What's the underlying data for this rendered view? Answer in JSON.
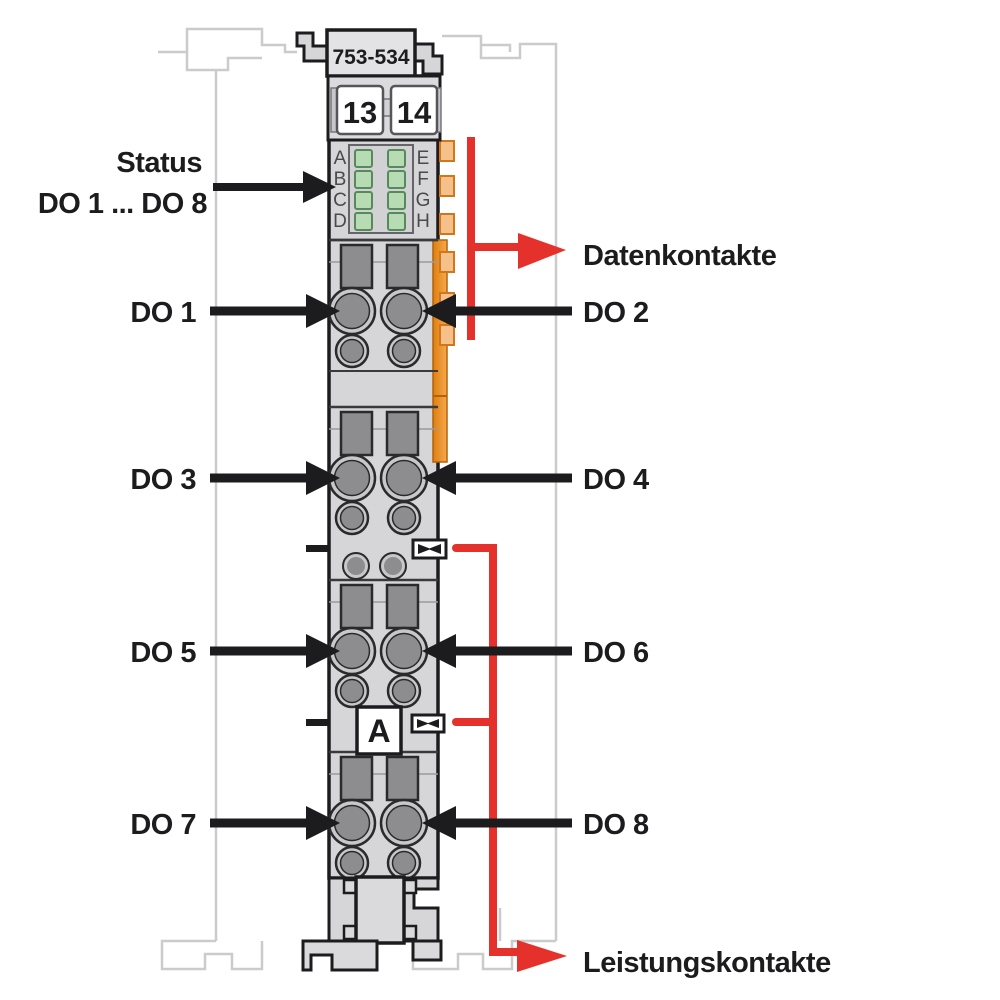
{
  "module": {
    "part_number": "753-534",
    "terminal_numbers": [
      "13",
      "14"
    ],
    "led_labels_left": [
      "A",
      "B",
      "C",
      "D"
    ],
    "led_labels_right": [
      "E",
      "F",
      "G",
      "H"
    ],
    "marking_label": "A"
  },
  "annotations": {
    "status_line1": "Status",
    "status_line2": "DO 1 ... DO 8",
    "left_channels": [
      "DO 1",
      "DO 3",
      "DO 5",
      "DO 7"
    ],
    "right_channels": [
      "DO 2",
      "DO 4",
      "DO 6",
      "DO 8"
    ],
    "data_contacts": "Datenkontakte",
    "power_contacts": "Leistungskontakte"
  },
  "colors": {
    "arrow_black": "#1c1c1e",
    "signal_red": "#e5312b",
    "module_gray": "#d6d6d8",
    "dark_gray": "#8d8d90",
    "orange_strip": "#ef9027",
    "orange_tab": "#f5c08a",
    "led_green": "#b7dcb4",
    "neighbor_outline_gray": "#cbcbcb"
  }
}
